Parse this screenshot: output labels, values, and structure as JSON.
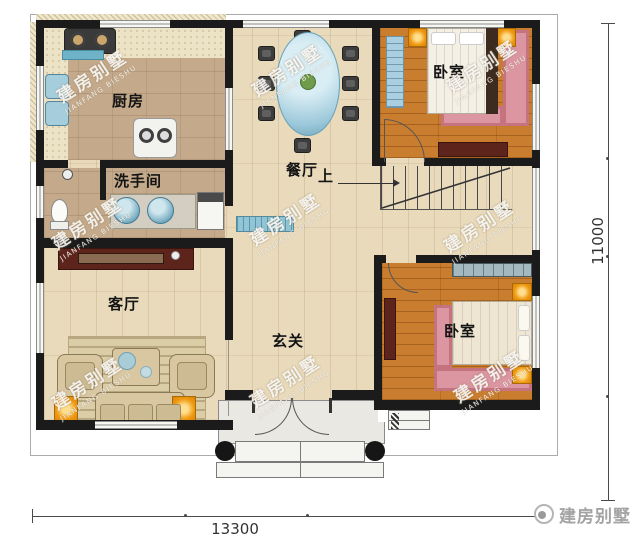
{
  "plan": {
    "rooms": {
      "kitchen": {
        "label": "厨房"
      },
      "bathroom": {
        "label": "洗手间"
      },
      "dining": {
        "label": "餐厅"
      },
      "bedroom_top": {
        "label": "卧室"
      },
      "bedroom_bottom": {
        "label": "卧室"
      },
      "living": {
        "label": "客厅"
      },
      "foyer": {
        "label": "玄关"
      }
    },
    "stairs": {
      "up_label": "上"
    },
    "dimensions": {
      "width": "13300",
      "height": "11000"
    },
    "watermark": {
      "cn": "建房别墅",
      "en": "JIANFANG BIESHU"
    },
    "logo": {
      "text": "建房别墅"
    },
    "colors": {
      "wall": "#1b1b1b",
      "floor_main": "#e8dabb",
      "floor_kitchen": "#c4aa8b",
      "floor_bedroom": "#c97d2f",
      "rug_pink": "#db96a1",
      "accent_orange": "#f09a12",
      "accent_blue": "#8fc2d6",
      "cabinet_dark_red": "#5d241c"
    }
  }
}
